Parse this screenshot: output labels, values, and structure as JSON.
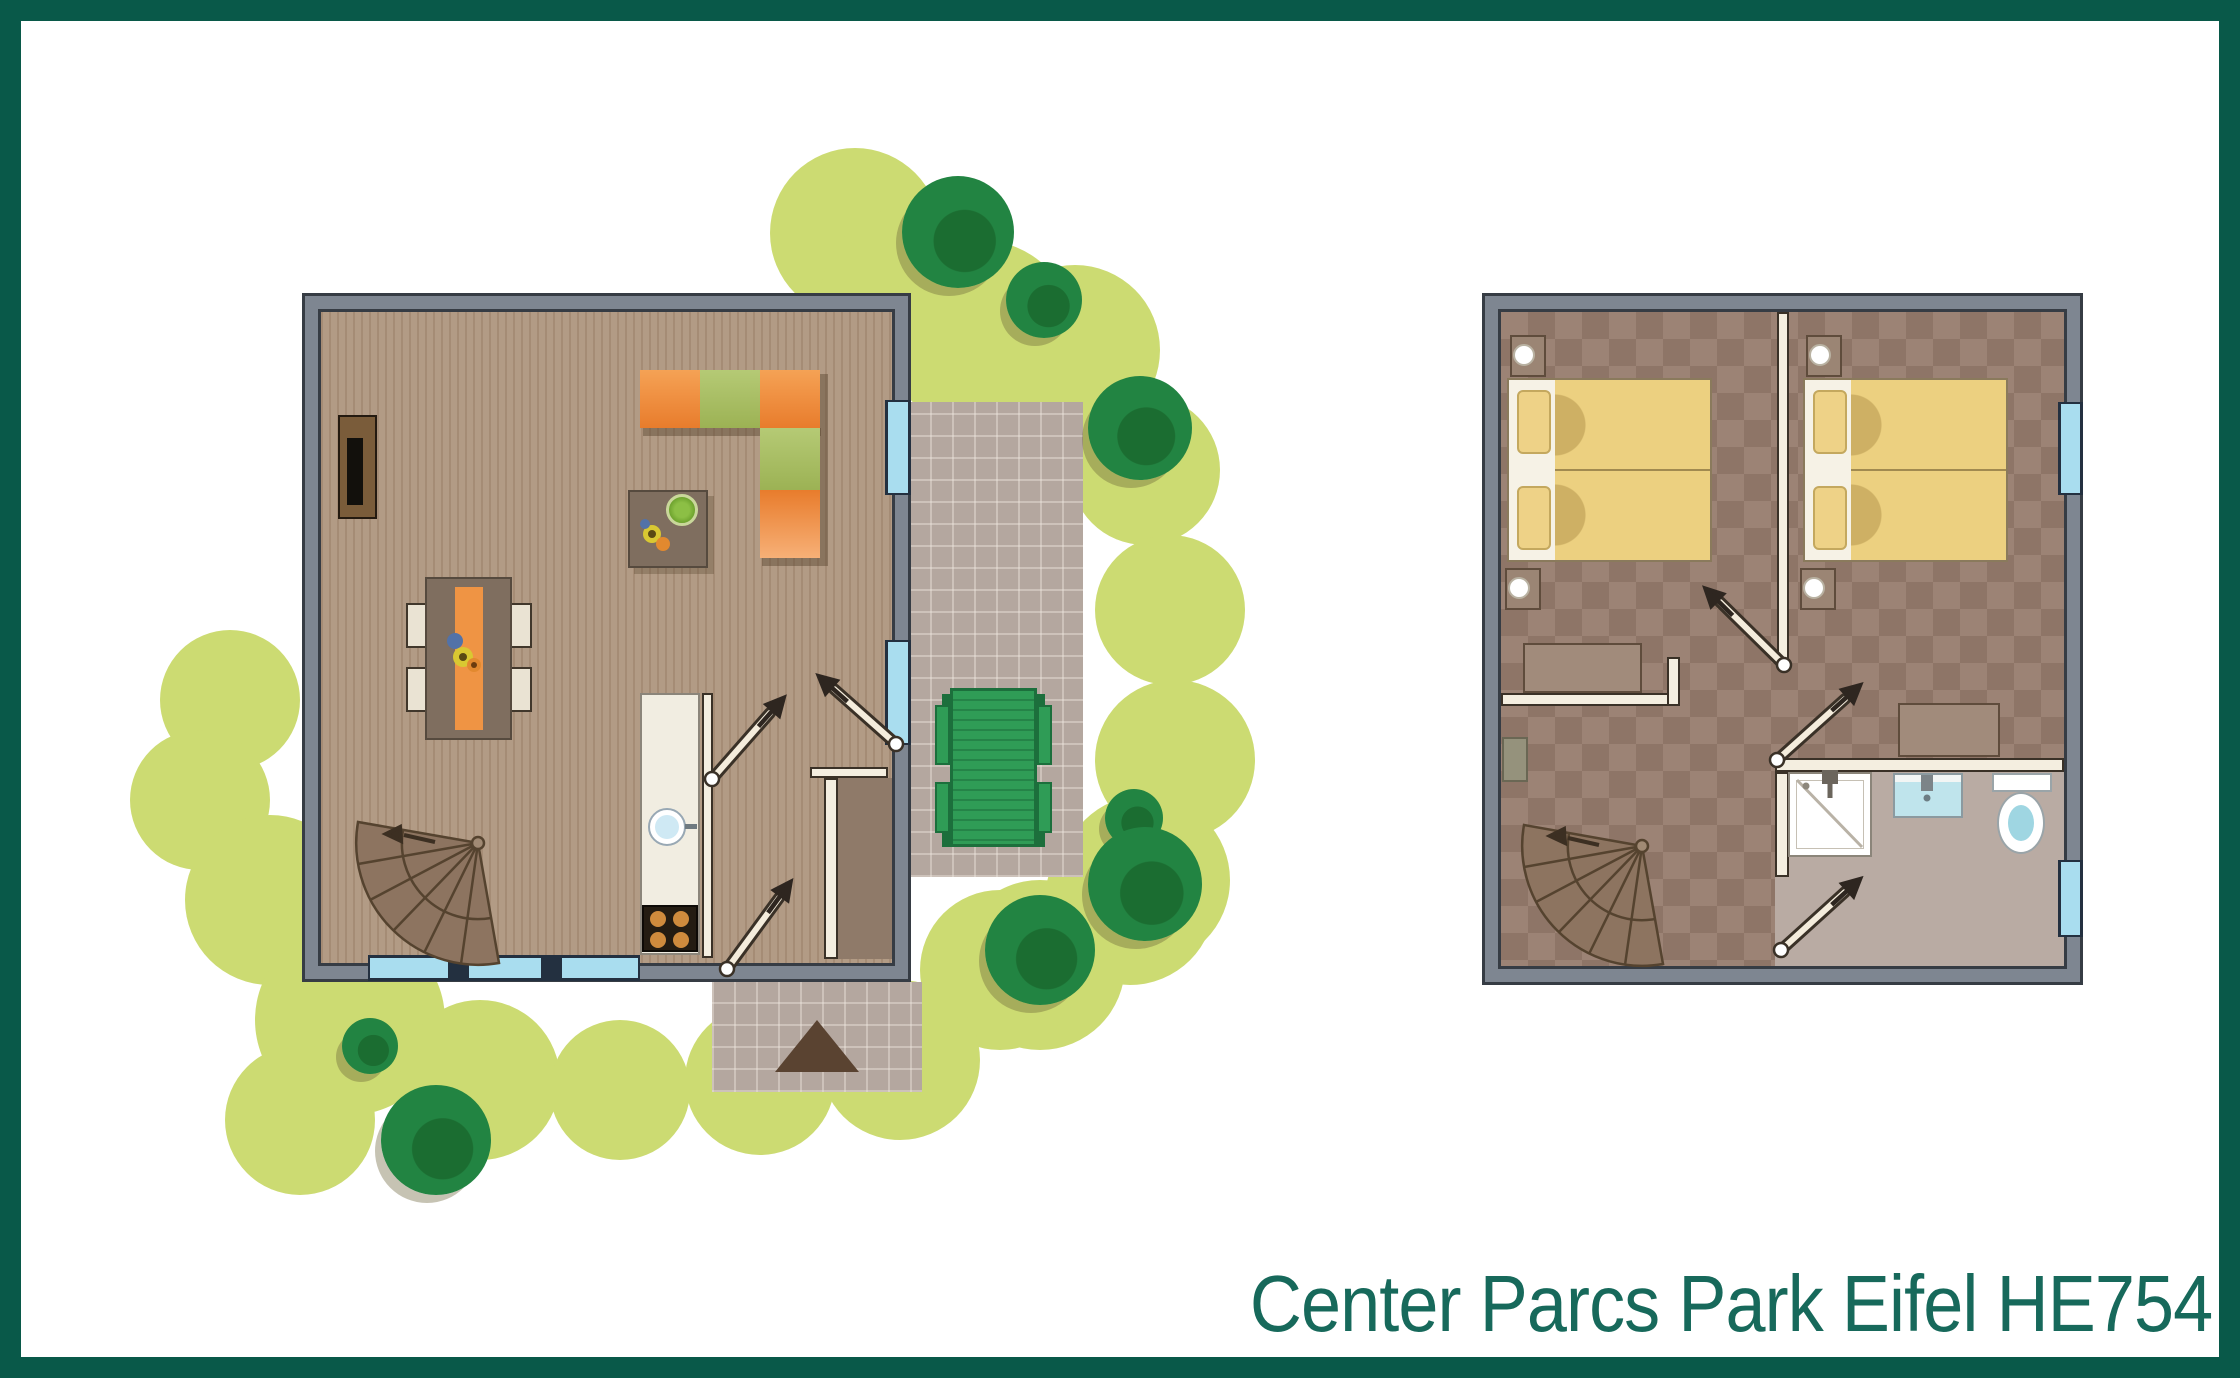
{
  "title": {
    "text": "Center Parcs Park Eifel HE754",
    "color": "#17695b"
  },
  "frame": {
    "border_color": "#095949",
    "background": "#ffffff"
  },
  "palette": {
    "wall_fill": "#7e8691",
    "wall_outline": "#363c44",
    "plank_floor": "#b29b85",
    "checker_floor_light": "#9c8375",
    "checker_floor_dark": "#8e7567",
    "window_glass": "#a9ddef",
    "window_frame": "#233040",
    "grass": "#ccdb72",
    "bush": "#228442",
    "terrace": "#b4a79f",
    "sofa_orange": "#ef8f3f",
    "sofa_green": "#a9c063",
    "dining_runner": "#ef9444",
    "chair": "#eae3d3",
    "kitchen_counter": "#f1ede1",
    "stove": "#241c12",
    "burner": "#cf8b3d",
    "bed_linen": "#ecd080",
    "bed_frame": "#f6f2e6",
    "nightstand": "#9b8574",
    "picnic_table": "#2f9c56",
    "bathroom_floor": "#b9aba3",
    "sink": "#bfe4ec",
    "stair_tread": "#8d7460",
    "door_leaf": "#f4ecdc",
    "porch_mat": "#5a4331"
  }
}
